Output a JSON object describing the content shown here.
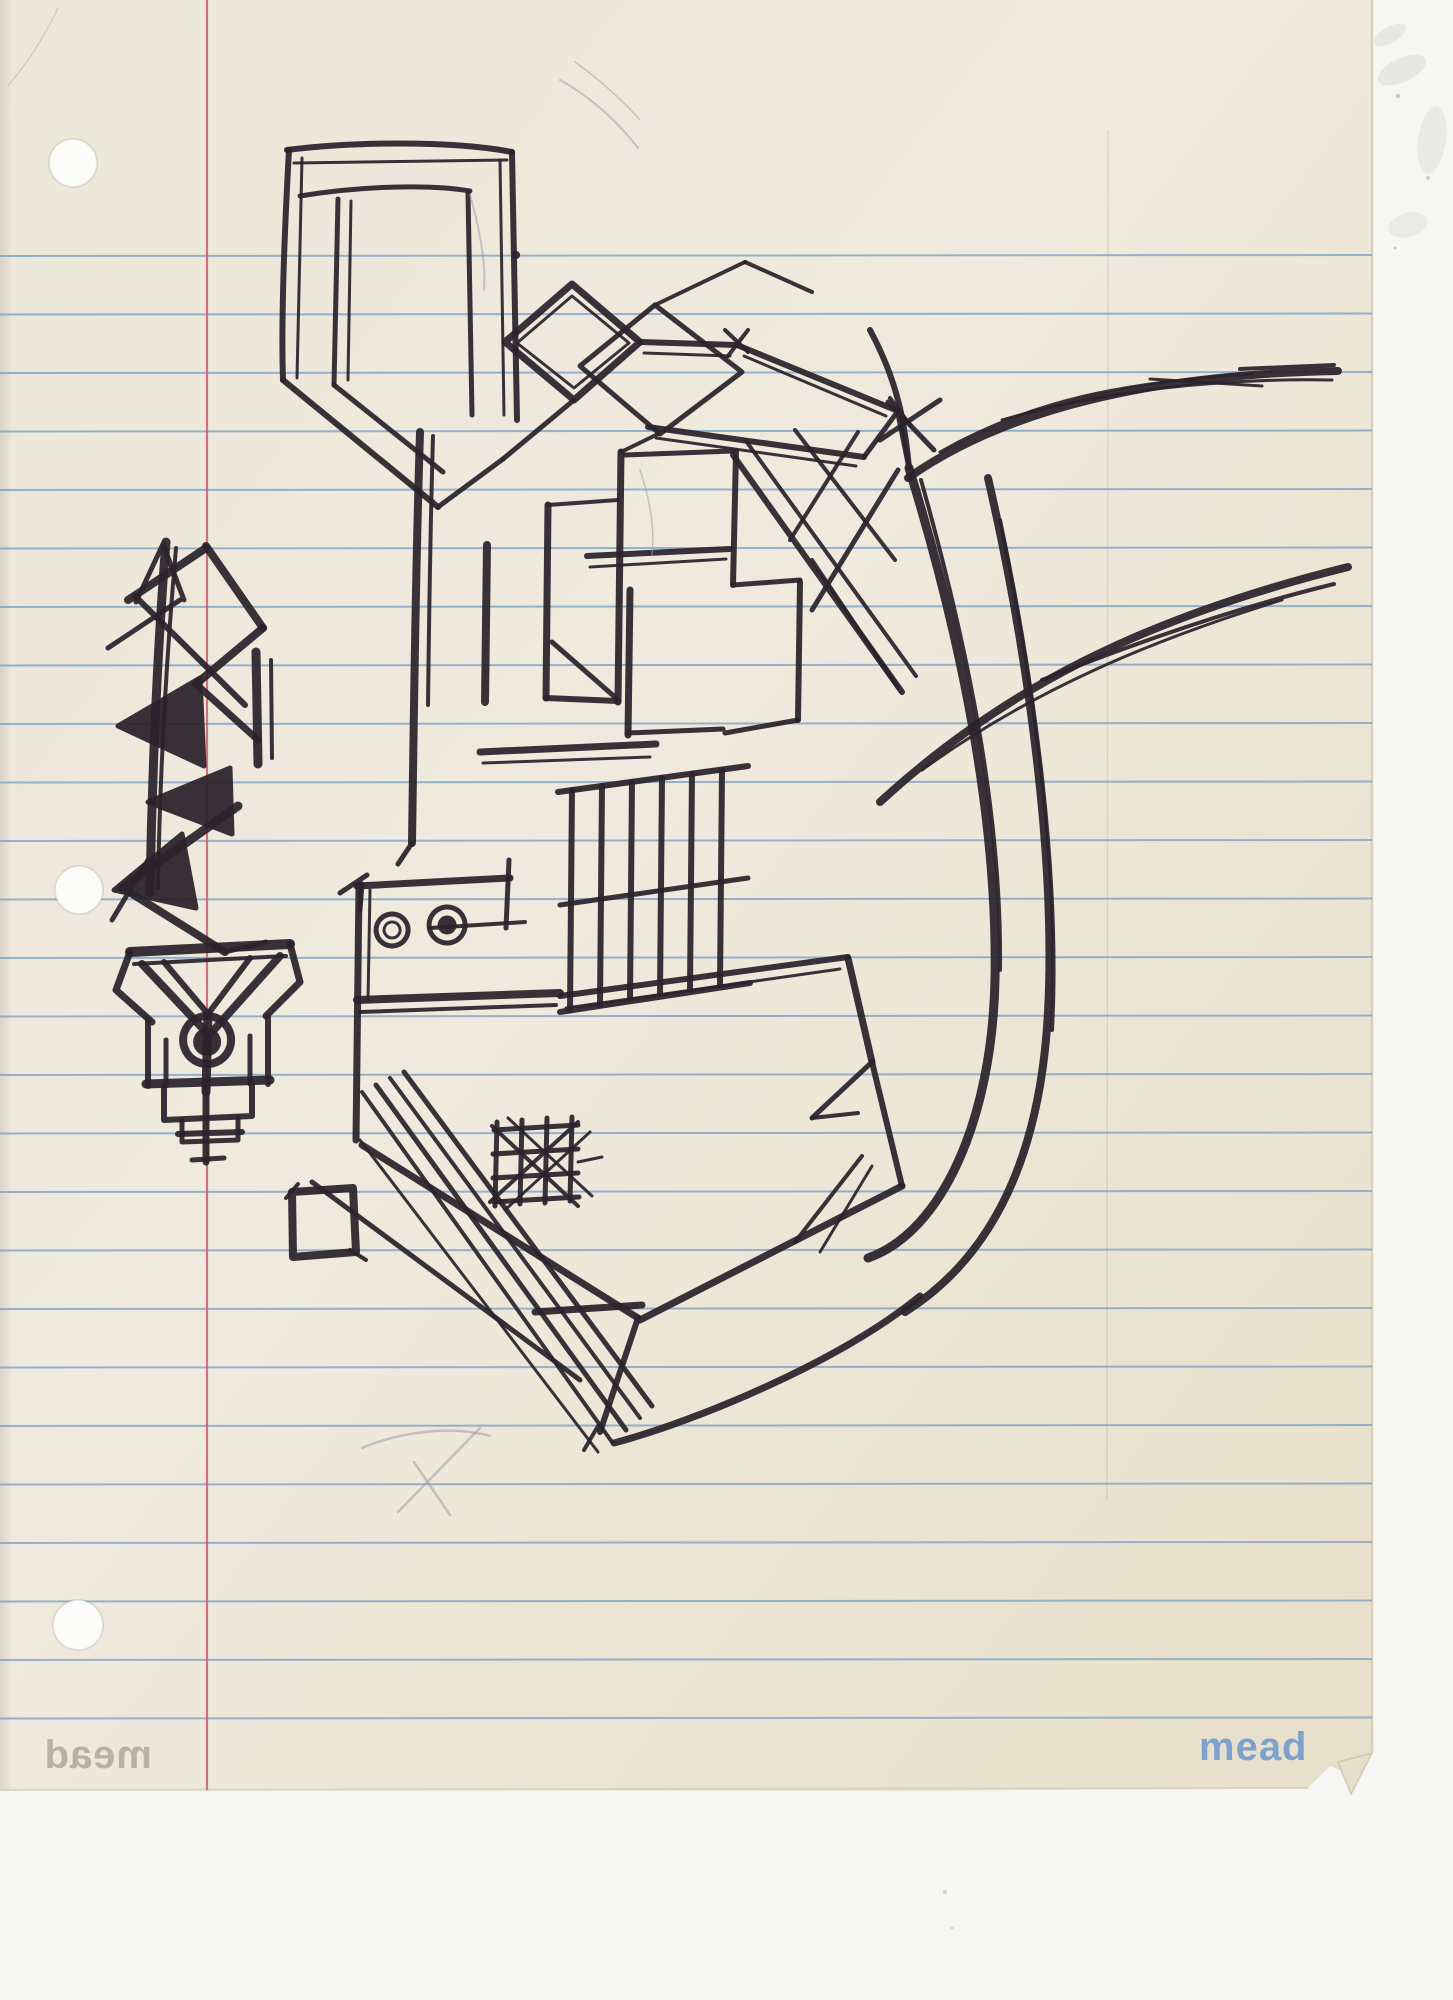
{
  "paper": {
    "brand": "mead",
    "brand_mirrored": "mead",
    "ruled_lines": {
      "count": 26,
      "first_y": 256,
      "spacing": 58.5,
      "x1": 0,
      "x2": 1372
    },
    "margin_line": {
      "x": 207,
      "y1": 0,
      "y2": 1790
    },
    "holes": [
      {
        "cx": 73,
        "cy": 163,
        "r": 24
      },
      {
        "cx": 79,
        "cy": 890,
        "r": 24
      },
      {
        "cx": 78,
        "cy": 1625,
        "r": 25
      }
    ]
  },
  "colors": {
    "paper_light": "#efeadd",
    "paper_mid": "#ece6d6",
    "paper_dark": "#e6dfca",
    "scanner_background": "#f6f7f4",
    "ruled_line": "#7fa3c6",
    "margin_line": "#cb5e6e",
    "ink": "#2b222b",
    "pencil": "#a39daa",
    "brand_blue": "#7ba3cd",
    "hole_fill": "#fcfcfa",
    "edge_shade": "#d7d0bd"
  },
  "sketch": {
    "ink_strokes": [
      {
        "d": "M166,542 C158,640 152,770 150,893",
        "w": 9
      },
      {
        "d": "M176,548 C168,640 160,760 158,888",
        "w": 4
      },
      {
        "d": "M136,602 L163,544 L184,600",
        "w": 5
      },
      {
        "d": "M206,548 L128,600",
        "w": 8
      },
      {
        "d": "M206,546 L263,628",
        "w": 8
      },
      {
        "d": "M263,628 L196,684",
        "w": 8
      },
      {
        "d": "M135,596 L245,705",
        "w": 6
      },
      {
        "d": "M108,648 L180,600",
        "w": 5
      },
      {
        "d": "M200,678 L118,726 L204,766 Z",
        "w": 5,
        "f": 1
      },
      {
        "d": "M196,684 L258,740",
        "w": 7
      },
      {
        "d": "M256,652 L258,764",
        "w": 9
      },
      {
        "d": "M271,660 L272,758",
        "w": 4
      },
      {
        "d": "M230,768 L148,802 L232,834 Z",
        "w": 5,
        "f": 1
      },
      {
        "d": "M182,834 L114,890 L196,908 Z",
        "w": 5,
        "f": 1
      },
      {
        "d": "M238,806 L122,888",
        "w": 9
      },
      {
        "d": "M126,890 L225,952",
        "w": 8
      },
      {
        "d": "M225,952 L266,942",
        "w": 5
      },
      {
        "d": "M148,860 L112,920",
        "w": 5
      },
      {
        "d": "M130,952 L290,944",
        "w": 10
      },
      {
        "d": "M134,964 L286,956",
        "w": 4
      },
      {
        "d": "M130,952 L116,990 L152,1022",
        "w": 7
      },
      {
        "d": "M290,944 L300,982 L266,1016",
        "w": 7
      },
      {
        "d": "M142,964 L206,1032",
        "w": 8
      },
      {
        "d": "M280,956 L212,1032",
        "w": 8
      },
      {
        "d": "M164,962 L208,1014 L250,958",
        "w": 6
      },
      {
        "d": "M208,1014 L206,1092",
        "w": 9
      },
      {
        "d": "M207,1016 a24,24 0 1,0 0.2,0",
        "w": 8
      },
      {
        "d": "M207,1030 a12,12 0 1,0 0.2,0 Z",
        "w": 4,
        "f": 1
      },
      {
        "d": "M148,1020 L148,1086",
        "w": 6
      },
      {
        "d": "M268,1016 L268,1084",
        "w": 6
      },
      {
        "d": "M166,1040 L166,1086",
        "w": 5
      },
      {
        "d": "M250,1036 L250,1084",
        "w": 5
      },
      {
        "d": "M146,1084 L270,1080",
        "w": 9
      },
      {
        "d": "M164,1086 L164,1120 L252,1116 L252,1084",
        "w": 6
      },
      {
        "d": "M182,1120 L182,1142 L238,1140 L238,1118",
        "w": 5
      },
      {
        "d": "M206,1086 L206,1162",
        "w": 7
      },
      {
        "d": "M178,1134 L242,1132",
        "w": 6
      },
      {
        "d": "M192,1160 L224,1158",
        "w": 5
      },
      {
        "d": "M287,150 C350,142 450,140 512,152",
        "w": 6
      },
      {
        "d": "M294,163 L507,160",
        "w": 3
      },
      {
        "d": "M289,150 C284,240 281,320 283,380",
        "w": 6
      },
      {
        "d": "M302,158 L297,378",
        "w": 3
      },
      {
        "d": "M512,152 L517,420",
        "w": 6
      },
      {
        "d": "M500,160 L504,415",
        "w": 3
      },
      {
        "d": "M300,196 C360,186 430,184 470,191",
        "w": 5
      },
      {
        "d": "M338,199 L334,385",
        "w": 5
      },
      {
        "d": "M351,201 L348,380",
        "w": 3
      },
      {
        "d": "M468,193 L472,415",
        "w": 5
      },
      {
        "d": "M283,380 L438,507",
        "w": 6
      },
      {
        "d": "M334,385 L443,472",
        "w": 5
      },
      {
        "d": "M438,507 L503,459",
        "w": 5
      },
      {
        "d": "M503,459 L574,400",
        "w": 5
      },
      {
        "d": "M505,342 L572,284 L640,342 L574,400 Z",
        "w": 7
      },
      {
        "d": "M517,343 L572,296 L629,343 L574,388 Z",
        "w": 3
      },
      {
        "d": "M640,342 L737,345",
        "w": 6
      },
      {
        "d": "M644,353 L730,356",
        "w": 3
      },
      {
        "d": "M737,345 L898,411",
        "w": 6
      },
      {
        "d": "M744,356 L886,416",
        "w": 3
      },
      {
        "d": "M898,411 L864,457",
        "w": 5
      },
      {
        "d": "M864,457 L648,427",
        "w": 6
      },
      {
        "d": "M656,438 L856,466",
        "w": 3
      },
      {
        "d": "M580,366 L655,305 L742,372 L660,434 Z",
        "w": 5
      },
      {
        "d": "M655,305 L745,262",
        "w": 4
      },
      {
        "d": "M745,262 L812,292",
        "w": 4
      },
      {
        "d": "M725,330 L748,352",
        "w": 4
      },
      {
        "d": "M748,330 L728,356",
        "w": 4
      },
      {
        "d": "M890,398 L910,425",
        "w": 4
      },
      {
        "d": "M898,414 L909,468",
        "w": 5
      },
      {
        "d": "M880,440 L940,400",
        "w": 5
      },
      {
        "d": "M888,402 L934,450",
        "w": 5
      },
      {
        "d": "M420,432 C416,560 414,700 412,843",
        "w": 8
      },
      {
        "d": "M433,436 C430,540 429,620 428,705",
        "w": 4
      },
      {
        "d": "M487,545 L485,702",
        "w": 8
      },
      {
        "d": "M548,505 L546,698",
        "w": 7
      },
      {
        "d": "M548,505 L618,500",
        "w": 4
      },
      {
        "d": "M546,698 L618,701",
        "w": 6
      },
      {
        "d": "M552,642 L616,698",
        "w": 5
      },
      {
        "d": "M621,452 L618,702",
        "w": 7
      },
      {
        "d": "M625,455 L733,451",
        "w": 5
      },
      {
        "d": "M621,452 L658,434",
        "w": 4
      },
      {
        "d": "M736,452 L733,585",
        "w": 6
      },
      {
        "d": "M733,585 L800,580",
        "w": 5
      },
      {
        "d": "M800,582 L798,720",
        "w": 6
      },
      {
        "d": "M798,720 L725,733",
        "w": 5
      },
      {
        "d": "M587,556 L730,549",
        "w": 6
      },
      {
        "d": "M590,567 L726,559",
        "w": 3
      },
      {
        "d": "M630,590 L628,735",
        "w": 7
      },
      {
        "d": "M628,733 L723,729",
        "w": 5
      },
      {
        "d": "M733,455 L902,692",
        "w": 6
      },
      {
        "d": "M746,441 L916,676",
        "w": 4
      },
      {
        "d": "M795,430 L895,560",
        "w": 4
      },
      {
        "d": "M858,432 L790,540",
        "w": 4
      },
      {
        "d": "M898,470 L812,610",
        "w": 5
      },
      {
        "d": "M812,560 L898,688",
        "w": 4
      },
      {
        "d": "M480,752 L656,744",
        "w": 7
      },
      {
        "d": "M483,763 L650,757",
        "w": 3
      },
      {
        "d": "M558,792 L748,766",
        "w": 6
      },
      {
        "d": "M560,905 L748,878",
        "w": 5
      },
      {
        "d": "M560,1012 L750,983",
        "w": 6
      },
      {
        "d": "M572,790 L570,1010",
        "w": 6
      },
      {
        "d": "M602,786 L600,1005",
        "w": 6
      },
      {
        "d": "M632,782 L630,999",
        "w": 6
      },
      {
        "d": "M662,778 L660,994",
        "w": 6
      },
      {
        "d": "M692,774 L690,989",
        "w": 6
      },
      {
        "d": "M722,770 L720,985",
        "w": 6
      },
      {
        "d": "M340,893 L367,875",
        "w": 5
      },
      {
        "d": "M362,884 L360,910",
        "w": 5
      },
      {
        "d": "M357,886 L510,878",
        "w": 7
      },
      {
        "d": "M509,860 L506,928",
        "w": 5
      },
      {
        "d": "M359,886 L356,1140",
        "w": 7
      },
      {
        "d": "M370,890 L368,1000",
        "w": 3
      },
      {
        "d": "M357,1000 L560,993",
        "w": 8
      },
      {
        "d": "M360,1012 L556,1005",
        "w": 4
      },
      {
        "d": "M392,914 a16,16 0 1,0 0.2,0",
        "w": 5
      },
      {
        "d": "M392,922 a8,8 0 1,0 0.2,0",
        "w": 3
      },
      {
        "d": "M447,907 a18,18 0 1,0 0.2,0",
        "w": 5
      },
      {
        "d": "M447,917 a8,8 0 1,0 0.2,0 Z",
        "w": 3,
        "f": 1
      },
      {
        "d": "M430,928 L525,922",
        "w": 4
      },
      {
        "d": "M412,843 L398,864",
        "w": 5
      },
      {
        "d": "M560,996 L848,957",
        "w": 6
      },
      {
        "d": "M566,1008 L840,969",
        "w": 3
      },
      {
        "d": "M848,958 L872,1062",
        "w": 7
      },
      {
        "d": "M872,1062 L902,1186",
        "w": 6
      },
      {
        "d": "M872,1062 L812,1118",
        "w": 5
      },
      {
        "d": "M812,1118 L858,1113",
        "w": 4
      },
      {
        "d": "M902,1186 L640,1320",
        "w": 7
      },
      {
        "d": "M795,1242 L862,1156",
        "w": 4
      },
      {
        "d": "M820,1252 L872,1166",
        "w": 3
      },
      {
        "d": "M362,1145 L638,1318",
        "w": 7
      },
      {
        "d": "M312,1182 L580,1380",
        "w": 5
      },
      {
        "d": "M638,1318 L600,1432",
        "w": 6
      },
      {
        "d": "M598,1426 L584,1450",
        "w": 4
      },
      {
        "d": "M535,1312 L642,1305",
        "w": 7
      },
      {
        "d": "M362,1092 L612,1442",
        "w": 4
      },
      {
        "d": "M376,1085 L626,1430",
        "w": 5
      },
      {
        "d": "M390,1078 L640,1418",
        "w": 4
      },
      {
        "d": "M404,1072 L652,1406",
        "w": 5
      },
      {
        "d": "M360,1140 L598,1452",
        "w": 3
      },
      {
        "d": "M494,1130 L578,1125",
        "w": 5
      },
      {
        "d": "M493,1154 L578,1149",
        "w": 5
      },
      {
        "d": "M493,1178 L578,1173",
        "w": 5
      },
      {
        "d": "M494,1202 L579,1197",
        "w": 5
      },
      {
        "d": "M497,1122 L495,1206",
        "w": 5
      },
      {
        "d": "M522,1120 L520,1204",
        "w": 5
      },
      {
        "d": "M547,1118 L545,1203",
        "w": 5
      },
      {
        "d": "M572,1117 L570,1201",
        "w": 5
      },
      {
        "d": "M490,1202 L578,1122",
        "w": 4
      },
      {
        "d": "M505,1210 L590,1132",
        "w": 3
      },
      {
        "d": "M492,1126 L578,1206",
        "w": 4
      },
      {
        "d": "M508,1118 L592,1196",
        "w": 3
      },
      {
        "d": "M578,1162 L602,1157",
        "w": 3
      },
      {
        "d": "M292,1192 L353,1188 L356,1252 L293,1257 Z",
        "w": 8
      },
      {
        "d": "M286,1198 L298,1184",
        "w": 4
      },
      {
        "d": "M350,1250 L366,1260",
        "w": 4
      },
      {
        "d": "M870,330 C898,382 905,424 909,468",
        "w": 6
      },
      {
        "d": "M909,468 C962,640 998,820 995,980 C992,1120 942,1232 868,1258",
        "w": 9
      },
      {
        "d": "M921,480 C966,640 1002,810 1000,970",
        "w": 4
      },
      {
        "d": "M988,478 C1030,660 1056,866 1048,1012 C1041,1144 1000,1252 905,1312",
        "w": 8
      },
      {
        "d": "M1000,520 C1036,690 1060,880 1052,1030",
        "w": 4
      },
      {
        "d": "M920,1296 C842,1360 700,1420 614,1443",
        "w": 7
      },
      {
        "d": "M908,478 C1004,410 1152,374 1338,371",
        "w": 8
      },
      {
        "d": "M940,452 C1032,400 1124,382 1252,374",
        "w": 3
      },
      {
        "d": "M1002,420 C1104,390 1222,378 1332,380",
        "w": 3
      },
      {
        "d": "M1240,369 L1334,365",
        "w": 4
      },
      {
        "d": "M1150,379 L1262,386",
        "w": 3
      },
      {
        "d": "M880,802 C1002,690 1142,618 1348,567",
        "w": 8
      },
      {
        "d": "M922,770 C1032,690 1152,640 1282,600",
        "w": 3
      },
      {
        "d": "M1042,680 C1142,640 1244,606 1334,584",
        "w": 4
      },
      {
        "d": "M516,252 a3,3 0 1,0 0.2,0 Z",
        "w": 2,
        "f": 1
      }
    ],
    "pencil_strokes": [
      {
        "d": "M362,1448 C405,1430 455,1426 490,1436",
        "w": 2.5
      },
      {
        "d": "M480,1428 L398,1512",
        "w": 2.5
      },
      {
        "d": "M414,1462 L450,1515",
        "w": 2.5
      },
      {
        "d": "M560,80 C592,98 618,122 638,148",
        "w": 2
      },
      {
        "d": "M575,62 C600,80 622,100 640,120",
        "w": 1.5
      },
      {
        "d": "M470,195 C480,230 486,262 484,290",
        "w": 2
      },
      {
        "d": "M640,470 C650,500 655,530 652,555",
        "w": 1.5
      }
    ]
  }
}
